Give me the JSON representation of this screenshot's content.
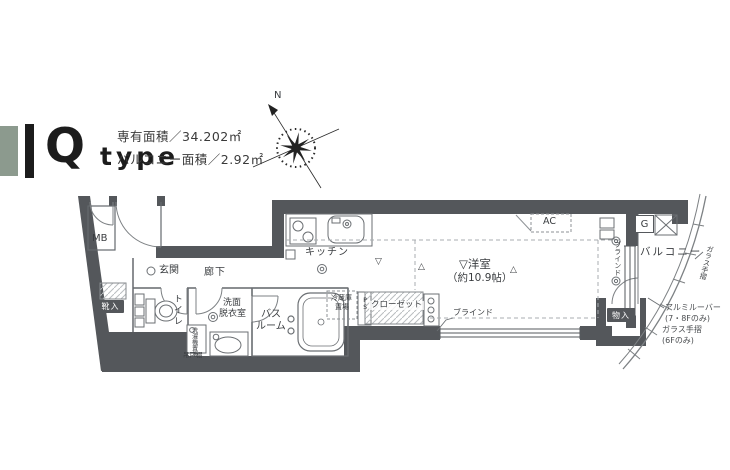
{
  "title": {
    "letter": "Q",
    "suffix": "type"
  },
  "area_info": {
    "line1": "専有面積／34.202㎡",
    "line2": "バルコニー面積／2.92㎡"
  },
  "compass": {
    "north": "N"
  },
  "labels": {
    "mb": "MB",
    "genkan": "玄関",
    "rouka": "廊下",
    "kutsuire": "靴入",
    "toilet": "トイレ",
    "senmen_l1": "洗面",
    "senmen_l2": "脱衣室",
    "sentakuki": "洗濯機置場",
    "tsuritodana": "吊戸棚",
    "bath_l1": "バス",
    "bath_l2": "ルーム",
    "kitchen": "キッチン",
    "fridge_l1": "冷蔵庫",
    "fridge_l2": "置場",
    "ps": "PS",
    "closet": "クローゼット",
    "room_l1": "▽洋室",
    "room_l2": "（約10.9帖）",
    "mark_down": "▽",
    "mark_up": "△",
    "ac": "AC",
    "blind_v": "ブラインド",
    "blind": "ブラインド",
    "balcony": "バルコニー",
    "gas": "G",
    "glass_rail": "ガラス手摺",
    "monoire": "物入",
    "note_l1": "アルミルーバー",
    "note_l2": "(7・8Fのみ)",
    "note_l3": "ガラス手摺",
    "note_l4": "(6Fのみ)"
  },
  "colors": {
    "wall": "#54575b",
    "accent_green": "#8c9a8e",
    "title_black": "#1c1c1c",
    "line": "#65696d"
  }
}
